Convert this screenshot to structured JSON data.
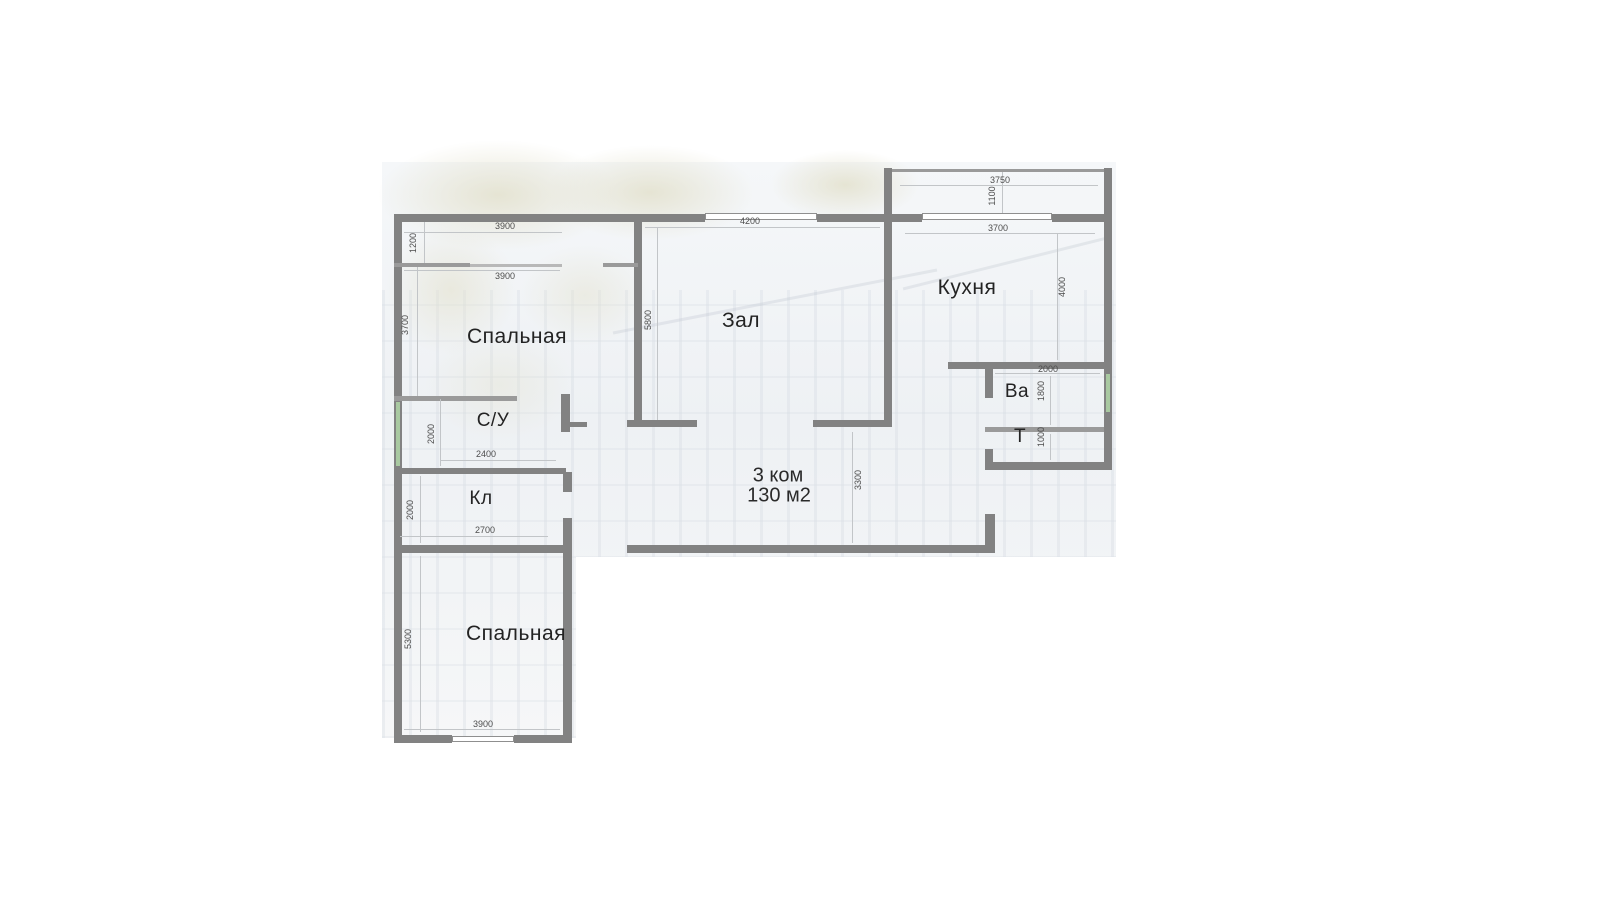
{
  "plan": {
    "area": {
      "rooms_line": "3 ком",
      "size_line": "130 м2"
    },
    "rooms": {
      "bedroom_top": "Спальная",
      "hall": "Зал",
      "kitchen": "Кухня",
      "wc": "С/У",
      "closet": "Кл",
      "bath": "Ва",
      "toilet": "Т",
      "bedroom_bottom": "Спальная"
    },
    "dims": {
      "top_strip_width": "3900",
      "top_strip_depth": "1200",
      "bedroom_top_width": "3900",
      "bedroom_top_depth": "3700",
      "hall_width": "4200",
      "hall_depth": "5800",
      "balcony_width": "3750",
      "balcony_depth": "1100",
      "kitchen_width": "3700",
      "kitchen_depth": "4000",
      "bath_width": "2000",
      "bath_depth": "1800",
      "toilet_depth": "1000",
      "corridor_depth": "3300",
      "wc_depth": "2000",
      "wc_width": "2400",
      "closet_depth": "2000",
      "closet_width": "2700",
      "bedroom_bottom_depth": "5300",
      "bedroom_bottom_width": "3900"
    }
  }
}
